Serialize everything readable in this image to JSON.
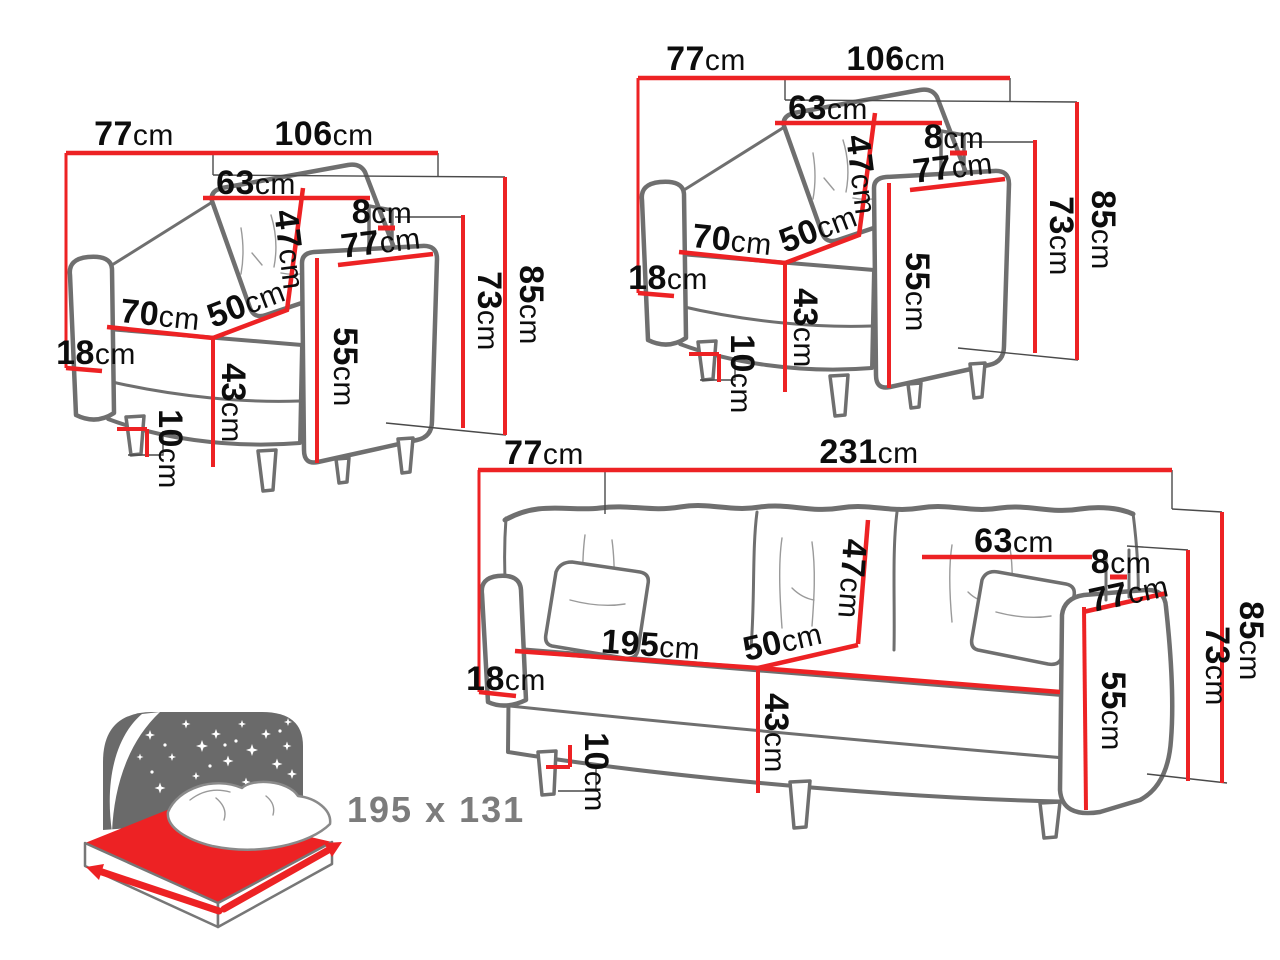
{
  "unit_suffix": "cm",
  "armchair": {
    "depth_top": "77",
    "width_total": "106",
    "back_cushion_width": "63",
    "back_gap": "8",
    "armrest_depth": "77",
    "back_cushion_height": "47",
    "seat_depth": "50",
    "seat_width": "70",
    "armrest_height": "55",
    "backrest_height": "73",
    "total_height": "85",
    "base_height": "18",
    "seat_height": "43",
    "leg_height": "10"
  },
  "sofa": {
    "depth_top": "77",
    "width_total": "231",
    "back_cushion_width": "63",
    "back_gap": "8",
    "armrest_depth": "77",
    "back_cushion_height": "47",
    "seat_width": "195",
    "seat_depth": "50",
    "armrest_height": "55",
    "backrest_height": "73",
    "total_height": "85",
    "base_height": "18",
    "seat_height": "43",
    "leg_height": "10"
  },
  "sleeping_function": {
    "dimensions_label": "195 x 131"
  },
  "colors": {
    "dimension_line": "#ed2224",
    "furniture_outline": "#6f6f6f",
    "guide_line": "#4a4a4a",
    "label_text": "#0d0d0d",
    "muted_text": "#7c7c7c",
    "icon_dark": "#6a6a6a",
    "icon_red": "#ed2224"
  }
}
